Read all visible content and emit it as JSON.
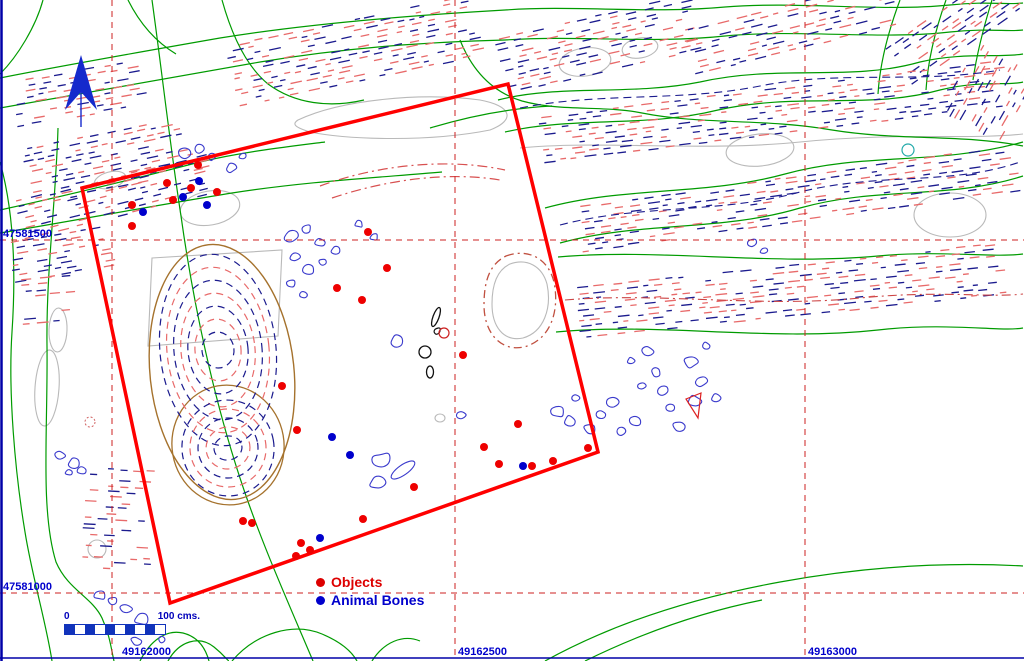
{
  "map": {
    "width": 1024,
    "height": 661,
    "background": "#ffffff",
    "border_color": "#0000a8"
  },
  "grid": {
    "line_color": "#cc2222",
    "label_color": "#0000cc",
    "verticals": [
      {
        "x": 112,
        "label": "49162000",
        "label_x": 122
      },
      {
        "x": 455,
        "label": "49162500",
        "label_x": 458
      },
      {
        "x": 805,
        "label": "49163000",
        "label_x": 808
      }
    ],
    "horizontals": [
      {
        "y": 240,
        "label": "47581500"
      },
      {
        "y": 593,
        "label": "47581000"
      }
    ]
  },
  "survey_square": {
    "color": "#ff0000",
    "corners": [
      [
        82,
        188
      ],
      [
        508,
        84
      ],
      [
        598,
        452
      ],
      [
        170,
        603
      ]
    ]
  },
  "north_arrow": {
    "color": "#1529cc"
  },
  "legend": {
    "objects": {
      "label": "Objects",
      "color": "#dd0000"
    },
    "animal_bones": {
      "label": "Animal Bones",
      "color": "#0000cc"
    }
  },
  "scale_bar": {
    "start_label": "0",
    "end_label": "100 cms.",
    "segments": 10,
    "color": "#1133bb"
  },
  "points": {
    "objects": {
      "color": "#ee0000",
      "radius": 4,
      "positions": [
        [
          198,
          165
        ],
        [
          167,
          183
        ],
        [
          191,
          188
        ],
        [
          217,
          192
        ],
        [
          173,
          200
        ],
        [
          132,
          205
        ],
        [
          132,
          226
        ],
        [
          368,
          232
        ],
        [
          387,
          268
        ],
        [
          337,
          288
        ],
        [
          362,
          300
        ],
        [
          463,
          355
        ],
        [
          282,
          386
        ],
        [
          297,
          430
        ],
        [
          414,
          487
        ],
        [
          484,
          447
        ],
        [
          499,
          464
        ],
        [
          518,
          424
        ],
        [
          532,
          466
        ],
        [
          553,
          461
        ],
        [
          588,
          448
        ],
        [
          243,
          521
        ],
        [
          252,
          523
        ],
        [
          301,
          543
        ],
        [
          310,
          550
        ],
        [
          296,
          556
        ],
        [
          363,
          519
        ]
      ]
    },
    "animal_bones": {
      "color": "#0000cc",
      "radius": 4,
      "positions": [
        [
          199,
          181
        ],
        [
          183,
          197
        ],
        [
          207,
          205
        ],
        [
          143,
          212
        ],
        [
          332,
          437
        ],
        [
          350,
          455
        ],
        [
          320,
          538
        ],
        [
          523,
          466
        ]
      ]
    }
  }
}
